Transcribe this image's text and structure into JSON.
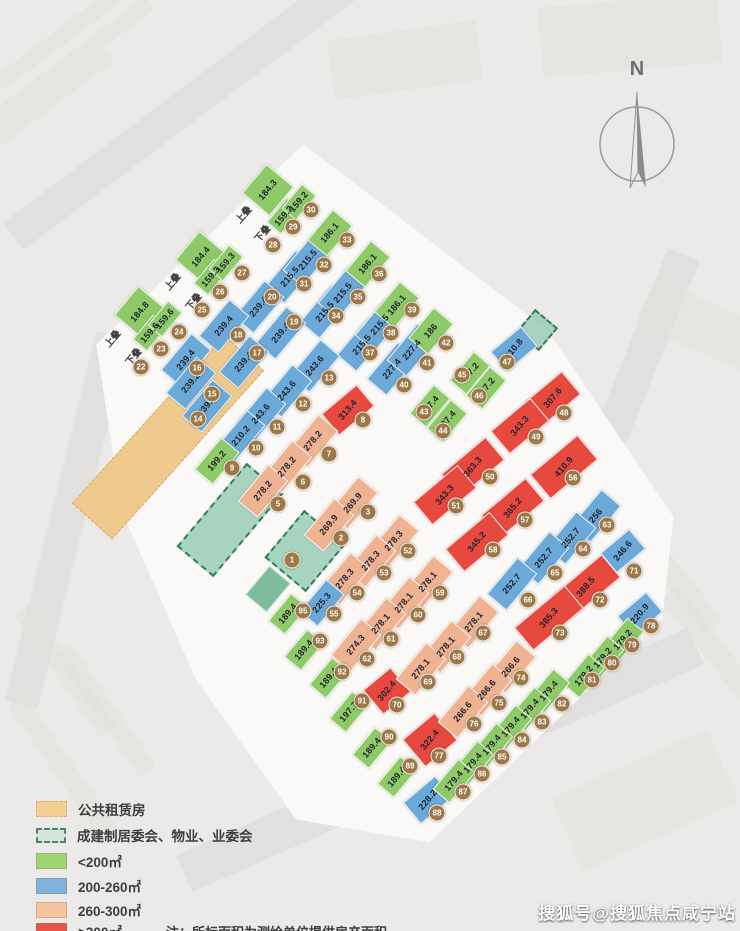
{
  "north_label": "N",
  "watermark": "搜狐号@搜狐焦点咸宁站",
  "legend": {
    "rows": [
      {
        "key": "pr",
        "label": "公共租赁房"
      },
      {
        "key": "cm",
        "label": "成建制居委会、物业、业委会"
      },
      {
        "key": "g",
        "label": "<200㎡"
      },
      {
        "key": "b",
        "label": "200-260㎡"
      },
      {
        "key": "s",
        "label": "260-300㎡"
      },
      {
        "key": "r",
        "label": ">300㎡"
      }
    ],
    "note": "注：所标面积为测绘单位提供房产面积。"
  },
  "colors": {
    "lt200_green": "#8ecb68",
    "b200_260_blue": "#6ba9d8",
    "s260_300_salmon": "#f0b392",
    "gt300_red": "#e7493e",
    "public_rental_orange": "#f0c98e",
    "committee_teal": "#94c9af",
    "badge_brown": "#9d7747"
  },
  "map": {
    "stacks": [
      {
        "t": "上叠",
        "x": 243,
        "y": 214
      },
      {
        "t": "下叠",
        "x": 262,
        "y": 233
      },
      {
        "t": "上叠",
        "x": 172,
        "y": 281
      },
      {
        "t": "下叠",
        "x": 193,
        "y": 301
      },
      {
        "t": "上叠",
        "x": 112,
        "y": 338
      },
      {
        "t": "下叠",
        "x": 133,
        "y": 356
      }
    ],
    "areas": [
      {
        "k": "pr",
        "x": 168,
        "y": 437,
        "w": 52,
        "h": 225,
        "r": 42
      },
      {
        "k": "cm",
        "x": 230,
        "y": 520,
        "w": 44,
        "h": 105,
        "r": 40
      },
      {
        "k": "cm",
        "x": 305,
        "y": 551,
        "w": 50,
        "h": 58,
        "r": 40
      },
      {
        "k": "cm",
        "x": 537,
        "y": 330,
        "w": 26,
        "h": 26,
        "r": 40
      },
      {
        "k": "cs",
        "x": 268,
        "y": 589,
        "w": 26,
        "h": 36,
        "r": 40
      }
    ],
    "units": [
      {
        "a": "184.3",
        "c": "g",
        "x": 268,
        "y": 190,
        "w": 34,
        "h": 36
      },
      {
        "a": "159.2",
        "c": "g",
        "x": 284,
        "y": 216,
        "w": 17,
        "h": 30
      },
      {
        "a": "159.2",
        "c": "g",
        "x": 299,
        "y": 202,
        "w": 17,
        "h": 30
      },
      {
        "a": "184.4",
        "c": "g",
        "x": 201,
        "y": 257,
        "w": 34,
        "h": 36
      },
      {
        "a": "159.3",
        "c": "g",
        "x": 211,
        "y": 277,
        "w": 17,
        "h": 30
      },
      {
        "a": "159.3",
        "c": "g",
        "x": 226,
        "y": 263,
        "w": 17,
        "h": 30
      },
      {
        "a": "184.8",
        "c": "g",
        "x": 140,
        "y": 312,
        "w": 34,
        "h": 36
      },
      {
        "a": "159.6",
        "c": "g",
        "x": 150,
        "y": 333,
        "w": 17,
        "h": 30
      },
      {
        "a": "159.6",
        "c": "g",
        "x": 165,
        "y": 319,
        "w": 17,
        "h": 30
      },
      {
        "a": "215.5",
        "c": "b",
        "x": 290,
        "y": 277
      },
      {
        "a": "215.5",
        "c": "b",
        "x": 308,
        "y": 260
      },
      {
        "a": "186.1",
        "c": "g",
        "x": 330,
        "y": 233,
        "h": 38
      },
      {
        "a": "215.5",
        "c": "b",
        "x": 325,
        "y": 312
      },
      {
        "a": "215.5",
        "c": "b",
        "x": 343,
        "y": 293
      },
      {
        "a": "186.1",
        "c": "g",
        "x": 368,
        "y": 264,
        "h": 38
      },
      {
        "a": "215.5",
        "c": "b",
        "x": 362,
        "y": 345
      },
      {
        "a": "215.5",
        "c": "b",
        "x": 380,
        "y": 325
      },
      {
        "a": "186.1",
        "c": "g",
        "x": 397,
        "y": 305,
        "h": 38
      },
      {
        "a": "227.4",
        "c": "b",
        "x": 392,
        "y": 369
      },
      {
        "a": "227.4",
        "c": "b",
        "x": 412,
        "y": 350
      },
      {
        "a": "186",
        "c": "g",
        "x": 431,
        "y": 331,
        "h": 38
      },
      {
        "a": "187.4",
        "c": "g",
        "x": 430,
        "y": 406,
        "w": 20,
        "h": 36
      },
      {
        "a": "187.4",
        "c": "g",
        "x": 447,
        "y": 421,
        "w": 20,
        "h": 36
      },
      {
        "a": "187.2",
        "c": "g",
        "x": 470,
        "y": 373,
        "w": 20,
        "h": 36
      },
      {
        "a": "187.2",
        "c": "g",
        "x": 486,
        "y": 388,
        "w": 20,
        "h": 36
      },
      {
        "a": "210.8",
        "c": "b",
        "x": 514,
        "y": 349,
        "w": 38,
        "h": 24,
        "r": -40
      },
      {
        "a": "307.6",
        "c": "r",
        "x": 553,
        "y": 398,
        "w": 46,
        "h": 28,
        "r": -40
      },
      {
        "a": "343.3",
        "c": "r",
        "x": 520,
        "y": 426,
        "w": 50,
        "h": 28,
        "r": -40
      },
      {
        "a": "313.4",
        "c": "r",
        "x": 348,
        "y": 410,
        "w": 44,
        "h": 26,
        "r": -40
      },
      {
        "a": "363.3",
        "c": "r",
        "x": 473,
        "y": 467,
        "w": 56,
        "h": 28,
        "r": -40
      },
      {
        "a": "343.3",
        "c": "r",
        "x": 445,
        "y": 495,
        "w": 56,
        "h": 28,
        "r": -40
      },
      {
        "a": "410.9",
        "c": "r",
        "x": 564,
        "y": 467,
        "w": 60,
        "h": 30,
        "r": -40
      },
      {
        "a": "365.2",
        "c": "r",
        "x": 513,
        "y": 508,
        "w": 56,
        "h": 28,
        "r": -40
      },
      {
        "a": "345.2",
        "c": "r",
        "x": 477,
        "y": 542,
        "w": 56,
        "h": 28,
        "r": -40
      },
      {
        "a": "388.5",
        "c": "r",
        "x": 586,
        "y": 587,
        "w": 64,
        "h": 28,
        "r": -40
      },
      {
        "a": "385.3",
        "c": "r",
        "x": 549,
        "y": 618,
        "w": 64,
        "h": 28,
        "r": -40
      },
      {
        "a": "302.4",
        "c": "r",
        "x": 387,
        "y": 691,
        "w": 34,
        "h": 30,
        "r": -40
      },
      {
        "a": "322.4",
        "c": "r",
        "x": 430,
        "y": 740,
        "w": 40,
        "h": 34,
        "r": -40
      },
      {
        "a": "239.4",
        "c": "b",
        "x": 259,
        "y": 307
      },
      {
        "a": "239.4",
        "c": "b",
        "x": 281,
        "y": 333
      },
      {
        "a": "239.4",
        "c": "b",
        "x": 224,
        "y": 326
      },
      {
        "a": "239.4",
        "c": "b",
        "x": 244,
        "y": 362
      },
      {
        "a": "239.4",
        "c": "b",
        "x": 186,
        "y": 360
      },
      {
        "a": "239.2",
        "c": "b",
        "x": 191,
        "y": 383
      },
      {
        "a": "239.2",
        "c": "b",
        "x": 207,
        "y": 406
      },
      {
        "a": "243.6",
        "c": "b",
        "x": 315,
        "y": 366
      },
      {
        "a": "243.6",
        "c": "b",
        "x": 287,
        "y": 391
      },
      {
        "a": "243.6",
        "c": "b",
        "x": 261,
        "y": 414
      },
      {
        "a": "210.2",
        "c": "b",
        "x": 241,
        "y": 436,
        "w": 22
      },
      {
        "a": "199.2",
        "c": "g",
        "x": 217,
        "y": 461,
        "w": 22,
        "h": 40
      },
      {
        "a": "278.2",
        "c": "s",
        "x": 313,
        "y": 441
      },
      {
        "a": "278.2",
        "c": "s",
        "x": 287,
        "y": 467
      },
      {
        "a": "278.2",
        "c": "s",
        "x": 263,
        "y": 491
      },
      {
        "a": "269.9",
        "c": "s",
        "x": 353,
        "y": 503
      },
      {
        "a": "269.9",
        "c": "s",
        "x": 329,
        "y": 525
      },
      {
        "a": "278.3",
        "c": "s",
        "x": 394,
        "y": 541
      },
      {
        "a": "278.3",
        "c": "s",
        "x": 371,
        "y": 561
      },
      {
        "a": "278.3",
        "c": "s",
        "x": 345,
        "y": 579
      },
      {
        "a": "225.3",
        "c": "b",
        "x": 322,
        "y": 603,
        "w": 22,
        "h": 40
      },
      {
        "a": "278.1",
        "c": "s",
        "x": 428,
        "y": 582
      },
      {
        "a": "278.1",
        "c": "s",
        "x": 404,
        "y": 603
      },
      {
        "a": "278.1",
        "c": "s",
        "x": 381,
        "y": 624
      },
      {
        "a": "274.3",
        "c": "s",
        "x": 356,
        "y": 645
      },
      {
        "a": "278.1",
        "c": "s",
        "x": 474,
        "y": 622
      },
      {
        "a": "278.1",
        "c": "s",
        "x": 446,
        "y": 647
      },
      {
        "a": "278.1",
        "c": "s",
        "x": 421,
        "y": 669
      },
      {
        "a": "266.6",
        "c": "s",
        "x": 511,
        "y": 667
      },
      {
        "a": "266.6",
        "c": "s",
        "x": 487,
        "y": 690
      },
      {
        "a": "266.6",
        "c": "s",
        "x": 463,
        "y": 712
      },
      {
        "a": "256",
        "c": "b",
        "x": 596,
        "y": 516
      },
      {
        "a": "252.7",
        "c": "b",
        "x": 571,
        "y": 538
      },
      {
        "a": "252.7",
        "c": "b",
        "x": 544,
        "y": 558
      },
      {
        "a": "252.7",
        "c": "b",
        "x": 512,
        "y": 584
      },
      {
        "a": "246.6",
        "c": "b",
        "x": 623,
        "y": 551,
        "w": 36,
        "h": 24,
        "r": -40
      },
      {
        "a": "220.9",
        "c": "b",
        "x": 640,
        "y": 614,
        "w": 36,
        "h": 24,
        "r": -40
      },
      {
        "a": "228.2",
        "c": "b",
        "x": 428,
        "y": 800,
        "w": 40,
        "h": 26,
        "r": -40
      },
      {
        "a": "179.2",
        "c": "g",
        "x": 623,
        "y": 640,
        "w": 20,
        "h": 38
      },
      {
        "a": "179.2",
        "c": "g",
        "x": 603,
        "y": 658,
        "w": 20,
        "h": 38
      },
      {
        "a": "179.2",
        "c": "g",
        "x": 584,
        "y": 676,
        "w": 20,
        "h": 38
      },
      {
        "a": "179.4",
        "c": "g",
        "x": 549,
        "y": 691,
        "w": 20,
        "h": 38
      },
      {
        "a": "179.4",
        "c": "g",
        "x": 530,
        "y": 709,
        "w": 20,
        "h": 38
      },
      {
        "a": "179.4",
        "c": "g",
        "x": 511,
        "y": 727,
        "w": 20,
        "h": 38
      },
      {
        "a": "179.4",
        "c": "g",
        "x": 492,
        "y": 745,
        "w": 20,
        "h": 38
      },
      {
        "a": "179.4",
        "c": "g",
        "x": 473,
        "y": 763,
        "w": 20,
        "h": 38
      },
      {
        "a": "179.4",
        "c": "g",
        "x": 454,
        "y": 781,
        "w": 20,
        "h": 38
      },
      {
        "a": "189.4",
        "c": "g",
        "x": 397,
        "y": 777,
        "w": 20,
        "h": 34
      },
      {
        "a": "189.4",
        "c": "g",
        "x": 372,
        "y": 748,
        "w": 20,
        "h": 34
      },
      {
        "a": "197.7",
        "c": "g",
        "x": 349,
        "y": 712,
        "w": 20,
        "h": 34
      },
      {
        "a": "189.4",
        "c": "g",
        "x": 329,
        "y": 678,
        "w": 20,
        "h": 34
      },
      {
        "a": "189.4",
        "c": "g",
        "x": 304,
        "y": 650,
        "w": 20,
        "h": 34
      },
      {
        "a": "189.4",
        "c": "g",
        "x": 288,
        "y": 614,
        "w": 20,
        "h": 34
      }
    ],
    "badges": [
      {
        "n": "1",
        "x": 292,
        "y": 560
      },
      {
        "n": "2",
        "x": 341,
        "y": 538
      },
      {
        "n": "3",
        "x": 368,
        "y": 512
      },
      {
        "n": "5",
        "x": 278,
        "y": 504
      },
      {
        "n": "6",
        "x": 303,
        "y": 482
      },
      {
        "n": "7",
        "x": 329,
        "y": 454
      },
      {
        "n": "8",
        "x": 363,
        "y": 420
      },
      {
        "n": "9",
        "x": 232,
        "y": 468
      },
      {
        "n": "10",
        "x": 256,
        "y": 448
      },
      {
        "n": "11",
        "x": 277,
        "y": 427
      },
      {
        "n": "12",
        "x": 303,
        "y": 404
      },
      {
        "n": "13",
        "x": 329,
        "y": 378
      },
      {
        "n": "14",
        "x": 198,
        "y": 419
      },
      {
        "n": "15",
        "x": 212,
        "y": 394
      },
      {
        "n": "16",
        "x": 197,
        "y": 368
      },
      {
        "n": "17",
        "x": 257,
        "y": 353
      },
      {
        "n": "18",
        "x": 238,
        "y": 335
      },
      {
        "n": "19",
        "x": 294,
        "y": 322
      },
      {
        "n": "20",
        "x": 272,
        "y": 297
      },
      {
        "n": "22",
        "x": 141,
        "y": 367
      },
      {
        "n": "23",
        "x": 161,
        "y": 349
      },
      {
        "n": "24",
        "x": 179,
        "y": 332
      },
      {
        "n": "25",
        "x": 202,
        "y": 310
      },
      {
        "n": "26",
        "x": 220,
        "y": 292
      },
      {
        "n": "27",
        "x": 242,
        "y": 273
      },
      {
        "n": "28",
        "x": 273,
        "y": 245
      },
      {
        "n": "29",
        "x": 293,
        "y": 227
      },
      {
        "n": "30",
        "x": 311,
        "y": 210
      },
      {
        "n": "31",
        "x": 304,
        "y": 284
      },
      {
        "n": "32",
        "x": 324,
        "y": 265
      },
      {
        "n": "33",
        "x": 347,
        "y": 240
      },
      {
        "n": "34",
        "x": 336,
        "y": 316
      },
      {
        "n": "35",
        "x": 358,
        "y": 297
      },
      {
        "n": "36",
        "x": 379,
        "y": 274
      },
      {
        "n": "37",
        "x": 370,
        "y": 353
      },
      {
        "n": "38",
        "x": 391,
        "y": 333
      },
      {
        "n": "39",
        "x": 412,
        "y": 310
      },
      {
        "n": "40",
        "x": 404,
        "y": 385
      },
      {
        "n": "41",
        "x": 427,
        "y": 363
      },
      {
        "n": "42",
        "x": 446,
        "y": 343
      },
      {
        "n": "43",
        "x": 424,
        "y": 412
      },
      {
        "n": "44",
        "x": 443,
        "y": 431
      },
      {
        "n": "45",
        "x": 462,
        "y": 375
      },
      {
        "n": "46",
        "x": 479,
        "y": 396
      },
      {
        "n": "47",
        "x": 507,
        "y": 362
      },
      {
        "n": "48",
        "x": 564,
        "y": 413
      },
      {
        "n": "49",
        "x": 536,
        "y": 437
      },
      {
        "n": "50",
        "x": 490,
        "y": 477
      },
      {
        "n": "51",
        "x": 456,
        "y": 506
      },
      {
        "n": "52",
        "x": 408,
        "y": 551
      },
      {
        "n": "53",
        "x": 384,
        "y": 573
      },
      {
        "n": "54",
        "x": 357,
        "y": 593
      },
      {
        "n": "55",
        "x": 334,
        "y": 614
      },
      {
        "n": "56",
        "x": 573,
        "y": 478
      },
      {
        "n": "57",
        "x": 525,
        "y": 520
      },
      {
        "n": "58",
        "x": 493,
        "y": 550
      },
      {
        "n": "59",
        "x": 440,
        "y": 593
      },
      {
        "n": "60",
        "x": 418,
        "y": 615
      },
      {
        "n": "61",
        "x": 391,
        "y": 639
      },
      {
        "n": "62",
        "x": 367,
        "y": 659
      },
      {
        "n": "63",
        "x": 607,
        "y": 525
      },
      {
        "n": "64",
        "x": 583,
        "y": 549
      },
      {
        "n": "65",
        "x": 555,
        "y": 573
      },
      {
        "n": "66",
        "x": 528,
        "y": 600
      },
      {
        "n": "67",
        "x": 483,
        "y": 633
      },
      {
        "n": "68",
        "x": 457,
        "y": 657
      },
      {
        "n": "69",
        "x": 428,
        "y": 682
      },
      {
        "n": "70",
        "x": 397,
        "y": 705
      },
      {
        "n": "71",
        "x": 634,
        "y": 571
      },
      {
        "n": "72",
        "x": 600,
        "y": 600
      },
      {
        "n": "73",
        "x": 560,
        "y": 633
      },
      {
        "n": "74",
        "x": 521,
        "y": 678
      },
      {
        "n": "75",
        "x": 499,
        "y": 703
      },
      {
        "n": "76",
        "x": 474,
        "y": 724
      },
      {
        "n": "77",
        "x": 439,
        "y": 756
      },
      {
        "n": "78",
        "x": 651,
        "y": 626
      },
      {
        "n": "79",
        "x": 632,
        "y": 645
      },
      {
        "n": "80",
        "x": 612,
        "y": 663
      },
      {
        "n": "81",
        "x": 592,
        "y": 680
      },
      {
        "n": "82",
        "x": 562,
        "y": 704
      },
      {
        "n": "83",
        "x": 542,
        "y": 722
      },
      {
        "n": "84",
        "x": 522,
        "y": 740
      },
      {
        "n": "85",
        "x": 502,
        "y": 757
      },
      {
        "n": "86",
        "x": 482,
        "y": 774
      },
      {
        "n": "87",
        "x": 463,
        "y": 792
      },
      {
        "n": "88",
        "x": 437,
        "y": 813
      },
      {
        "n": "89",
        "x": 410,
        "y": 766
      },
      {
        "n": "90",
        "x": 389,
        "y": 737
      },
      {
        "n": "91",
        "x": 362,
        "y": 701
      },
      {
        "n": "92",
        "x": 342,
        "y": 672
      },
      {
        "n": "93",
        "x": 320,
        "y": 641
      },
      {
        "n": "95",
        "x": 303,
        "y": 611
      }
    ]
  }
}
